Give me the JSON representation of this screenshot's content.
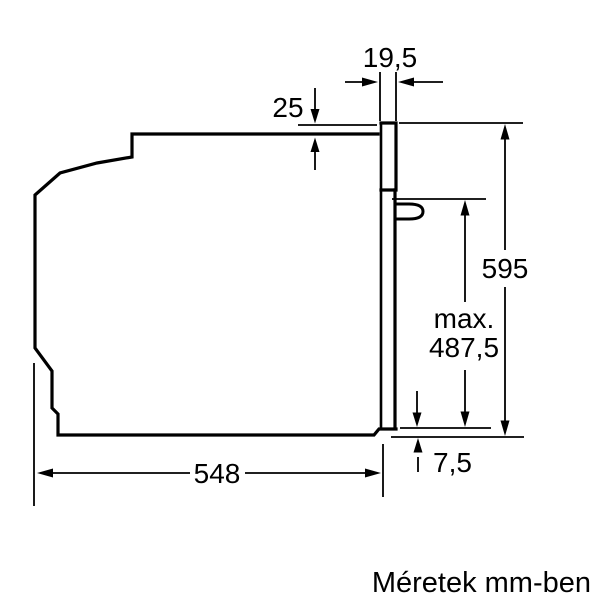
{
  "page": {
    "background": "#ffffff",
    "line_color": "#000000",
    "caption": "Méretek mm-ben"
  },
  "drawing": {
    "type": "technical-drawing",
    "subject": "built-in-oven-side-profile",
    "dimensions": {
      "panel_depth": "19,5",
      "panel_top_offset": "25",
      "front_height": "595",
      "max_prefix": "max.",
      "max_height": "487,5",
      "bottom_clearance": "7,5",
      "body_depth": "548"
    }
  }
}
